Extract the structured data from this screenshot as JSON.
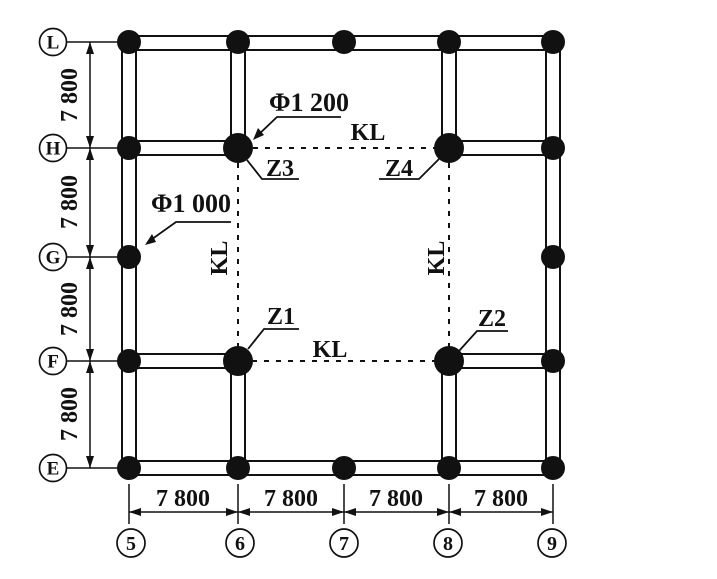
{
  "axes": {
    "rows": [
      "L",
      "H",
      "G",
      "F",
      "E"
    ],
    "cols": [
      "5",
      "6",
      "7",
      "8",
      "9"
    ]
  },
  "dimensions": {
    "vertical": [
      "7 800",
      "7 800",
      "7 800",
      "7 800"
    ],
    "horizontal": [
      "7 800",
      "7 800",
      "7 800",
      "7 800"
    ]
  },
  "labels": {
    "beam": "KL",
    "phi_large": "Φ1 200",
    "phi_small": "Φ1 000",
    "z1": "Z1",
    "z2": "Z2",
    "z3": "Z3",
    "z4": "Z4"
  },
  "colors": {
    "ink": "#111111",
    "background": "#ffffff"
  }
}
